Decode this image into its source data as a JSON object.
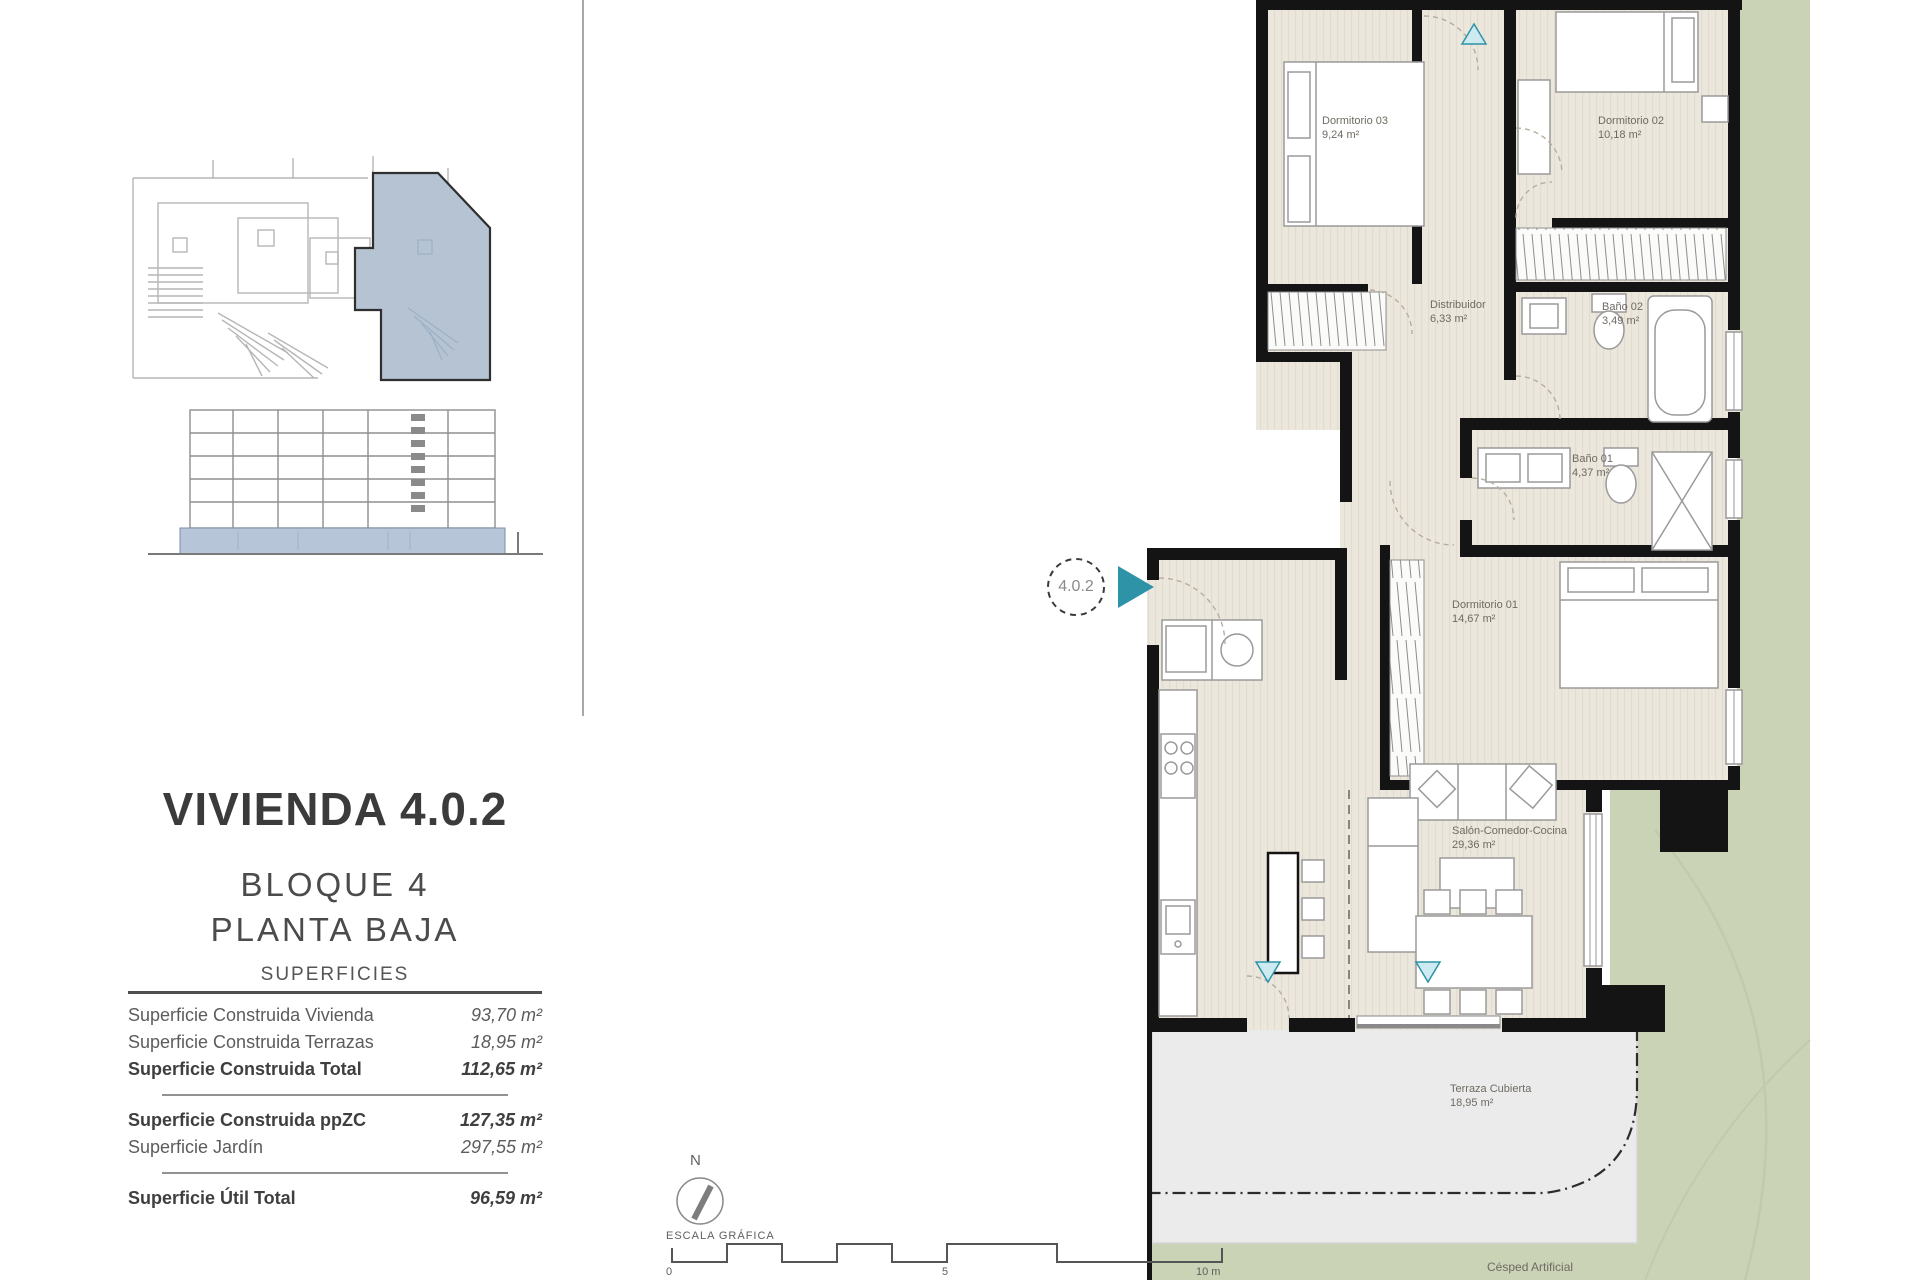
{
  "left_panel": {
    "title": "VIVIENDA 4.0.2",
    "block_line1": "BLOQUE 4",
    "block_line2": "PLANTA BAJA",
    "table": {
      "header": "SUPERFICIES",
      "groups": [
        {
          "rows": [
            {
              "label": "Superficie Construida Vivienda",
              "value": "93,70 m²"
            },
            {
              "label": "Superficie Construida Terrazas",
              "value": "18,95 m²"
            },
            {
              "label": "Superficie Construida Total",
              "value": "112,65 m²"
            }
          ]
        },
        {
          "rows": [
            {
              "label": "Superficie Construida ppZC",
              "value": "127,35 m²"
            },
            {
              "label": "Superficie Jardín",
              "value": "297,55 m²"
            }
          ]
        },
        {
          "rows": [
            {
              "label": "Superficie Útil Total",
              "value": "96,59 m²"
            }
          ]
        }
      ]
    }
  },
  "plan": {
    "unit_marker": "4.0.2",
    "rooms": [
      {
        "name": "Dormitorio 03",
        "area": "9,24 m²"
      },
      {
        "name": "Dormitorio 02",
        "area": "10,18 m²"
      },
      {
        "name": "Distribuidor",
        "area": "6,33 m²"
      },
      {
        "name": "Baño 02",
        "area": "3,49 m²"
      },
      {
        "name": "Baño 01",
        "area": "4,37 m²"
      },
      {
        "name": "Dormitorio 01",
        "area": "14,67 m²"
      },
      {
        "name": "Salón-Comedor-Cocina",
        "area": "29,36 m²"
      },
      {
        "name": "Terraza Cubierta",
        "area": "18,95 m²"
      }
    ],
    "garden_label": "Césped Artificial",
    "colors": {
      "garden": "#cbd3b6",
      "floor": "#ece7dd",
      "terrace": "#ebebeb",
      "wall": "#141414",
      "accent_teal": "#2f93a8",
      "highlight_blue": "#b5c3d3"
    }
  },
  "footer": {
    "north_label": "N",
    "scale_label": "ESCALA GRÁFICA",
    "scale_ticks": [
      "0",
      "5",
      "10 m"
    ]
  }
}
